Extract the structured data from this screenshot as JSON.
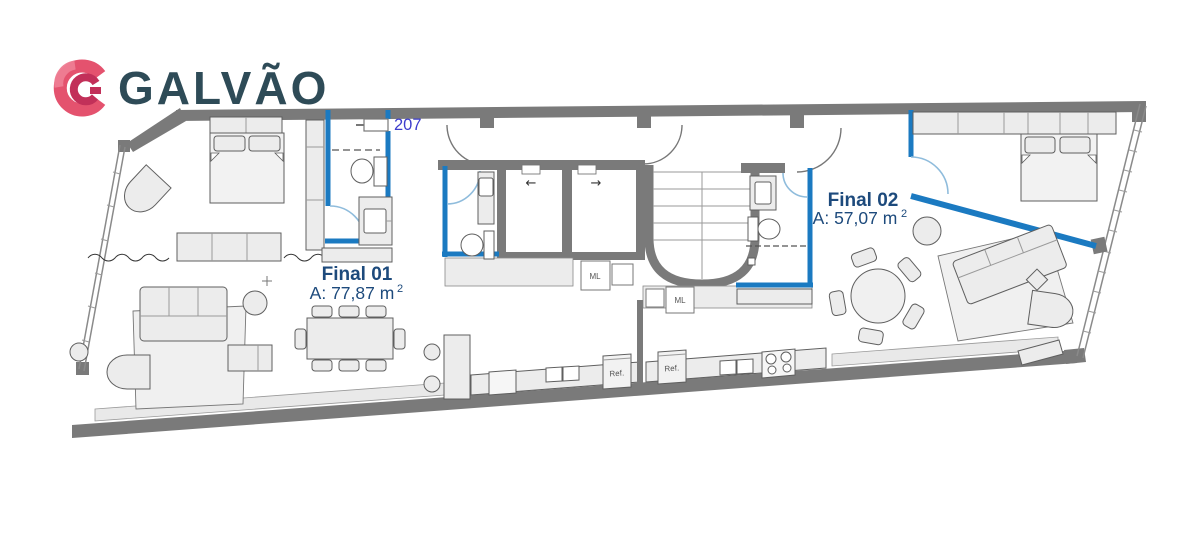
{
  "logo": {
    "brand": "GALVÃO"
  },
  "plan": {
    "unit_number": "207",
    "units": [
      {
        "id": "final-01",
        "name": "Final 01",
        "area_prefix": "A: 77,87 m",
        "area_exponent": "2"
      },
      {
        "id": "final-02",
        "name": "Final 02",
        "area_prefix": "A: 57,07 m",
        "area_exponent": "2"
      }
    ],
    "labels": {
      "washing_machine": "ML",
      "fridge": "Ref."
    },
    "elevators": {
      "left_arrow": "←",
      "right_arrow": "→"
    },
    "colors": {
      "wall_gray": "#7a7a7a",
      "unit_wall_blue": "#1b7ac1",
      "door_arc_blue": "#8fbcdc",
      "label_navy": "#1d4a7c",
      "unit_number_blue": "#3d3dcd",
      "furniture_fill": "#ececec",
      "logo_red": "#e4526e",
      "logo_dark_red": "#c23059",
      "logo_slate": "#2e4b57"
    }
  }
}
